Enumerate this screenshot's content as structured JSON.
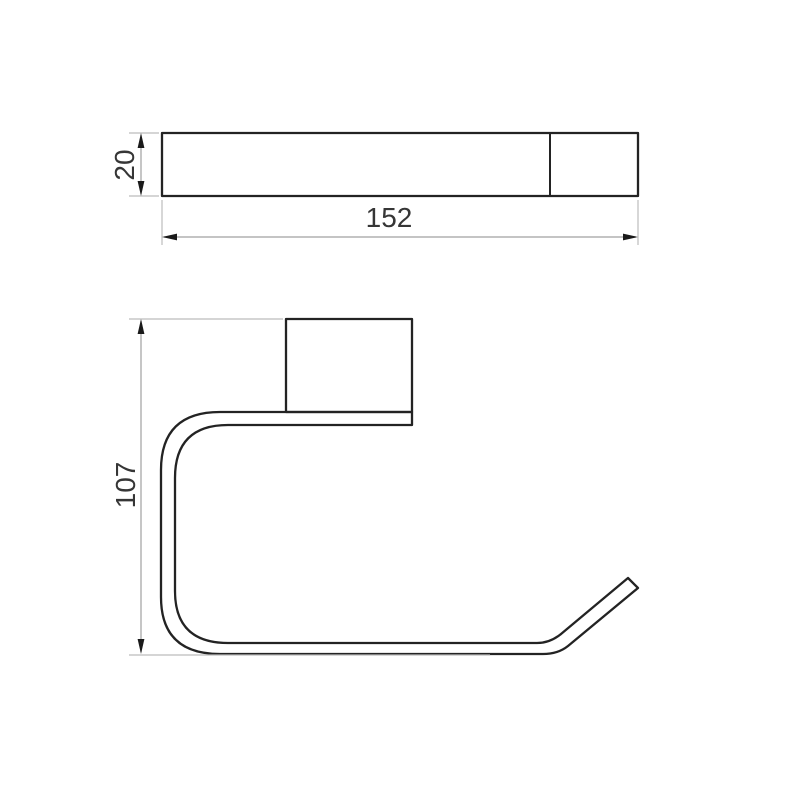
{
  "drawing": {
    "background_color": "#ffffff",
    "part_line_color": "#232323",
    "dimension_line_color": "#a0a0a0",
    "extension_line_color": "#bcbcbc",
    "arrow_color": "#1a1a1a",
    "label_color": "#363636",
    "top_view": {
      "height_dimension": "20",
      "width_dimension": "152"
    },
    "front_view": {
      "height_dimension": "107"
    }
  }
}
